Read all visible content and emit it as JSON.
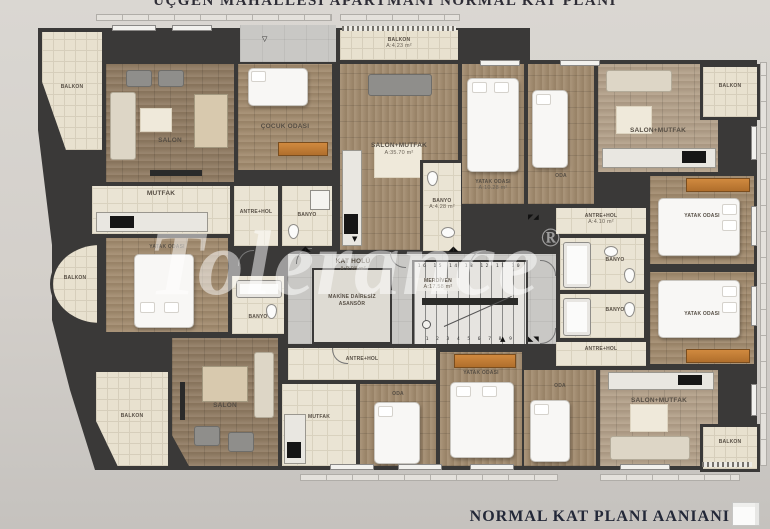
{
  "titles": {
    "top": "ÜÇGEN MAHALLESİ APARTMANI NORMAL KAT PLANI",
    "bottom_right": "NORMAL KAT PLANI AANIANI"
  },
  "watermark": {
    "text": "Tolerance",
    "registered": "®"
  },
  "core": {
    "kat_holu": {
      "name": "KAT HOLÜ",
      "area": "A:9.98 m²"
    },
    "asansor": {
      "line1": "MAKİNE DAİRESİZ",
      "line2": "ASANSÖR"
    },
    "merdiven": {
      "name": "MERDİVEN",
      "area": "A:17.58 m²",
      "top_numbers": "16 15 14 13 12 11 10",
      "bottom_numbers": "1 2 3 4 5 6 7 8 9"
    }
  },
  "rooms": {
    "balkon_tl": {
      "name": "BALKON",
      "area": ""
    },
    "salon_tl": {
      "name": "SALON",
      "area": ""
    },
    "cocuk_odasi": {
      "name": "ÇOCUK ODASI",
      "area": ""
    },
    "mutfak_tl": {
      "name": "MUTFAK",
      "area": ""
    },
    "antre_tl": {
      "name": "ANTRE+HOL",
      "area": ""
    },
    "banyo_tl": {
      "name": "BANYO",
      "area": ""
    },
    "balkon_a2": {
      "name": "BALKON",
      "area": "A:4.23 m²"
    },
    "salon_mutfak_a2": {
      "name": "SALON+MUTFAK",
      "area": "A:35.70 m²"
    },
    "banyo_a2": {
      "name": "BANYO",
      "area": "A:4.28 m²"
    },
    "yatak_a3": {
      "name": "YATAK ODASI",
      "area": "A:10.28 m²"
    },
    "oda_a3": {
      "name": "ODA",
      "area": ""
    },
    "antre_a3": {
      "name": "ANTRE+HOL",
      "area": "A:4.10 m²"
    },
    "banyo_a3": {
      "name": "BANYO",
      "area": ""
    },
    "salon_mutfak_a3": {
      "name": "SALON+MUTFAK",
      "area": ""
    },
    "balkon_a3": {
      "name": "BALKON",
      "area": ""
    },
    "yatak_a3r": {
      "name": "YATAK ODASI",
      "area": ""
    },
    "yatak_a4r": {
      "name": "YATAK ODASI",
      "area": ""
    },
    "banyo_a4": {
      "name": "BANYO",
      "area": ""
    },
    "antre_a4": {
      "name": "ANTRE+HOL",
      "area": ""
    },
    "oda_a4": {
      "name": "ODA",
      "area": ""
    },
    "salon_mutfak_a4": {
      "name": "SALON+MUTFAK",
      "area": ""
    },
    "balkon_a4": {
      "name": "BALKON",
      "area": ""
    },
    "antre_a5": {
      "name": "ANTRE+HOL",
      "area": ""
    },
    "mutfak_a5": {
      "name": "MUTFAK",
      "area": ""
    },
    "oda_a5": {
      "name": "ODA",
      "area": ""
    },
    "yatak_a5": {
      "name": "YATAK ODASI",
      "area": ""
    },
    "balkon_round": {
      "name": "BALKON",
      "area": ""
    },
    "yatak_a6": {
      "name": "YATAK ODASI",
      "area": ""
    },
    "banyo_a6": {
      "name": "BANYO",
      "area": ""
    },
    "salon_a6": {
      "name": "SALON",
      "area": ""
    },
    "balkon_bl": {
      "name": "BALKON",
      "area": ""
    }
  }
}
